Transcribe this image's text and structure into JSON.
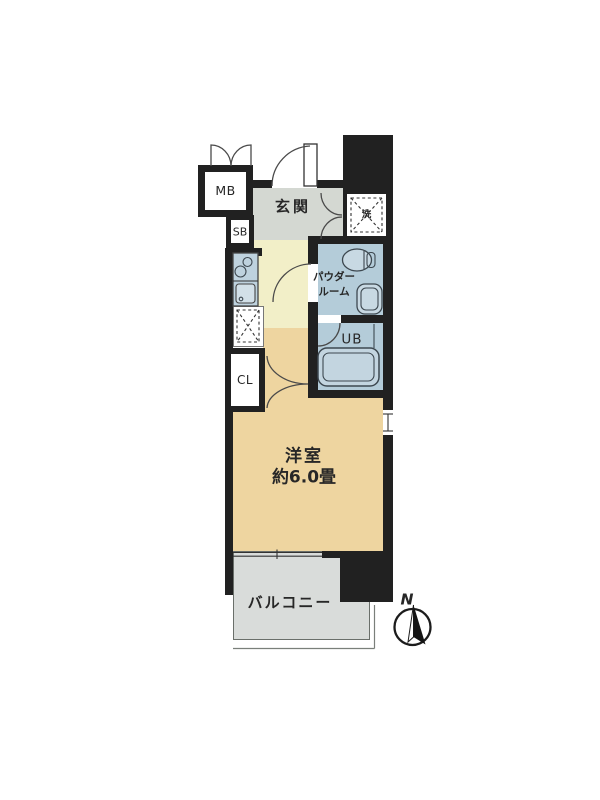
{
  "title": "1K apartment floor plan",
  "labels": {
    "meter_box": "MB",
    "shoe_box": "SB",
    "entry": "玄関",
    "laundry_mark": "洗",
    "powder_room": [
      "パウダー",
      "ルーム"
    ],
    "unit_bath": "UB",
    "closet": "CL",
    "main_room": [
      "洋室",
      "約6.0畳"
    ],
    "balcony": "バルコニー",
    "compass_north": "N"
  },
  "colors": {
    "wall": "#212121",
    "entry_floor": "#d4d8d2",
    "hall_floor": "#f2efc8",
    "room_floor": "#eed5a0",
    "wet_area_floor": "#b4ccd9",
    "balcony_floor": "#d9dcda",
    "counter_fill": "#bed2de",
    "fixture_fill": "#c8d9e3",
    "tub_fill": "#c3d5e0"
  }
}
